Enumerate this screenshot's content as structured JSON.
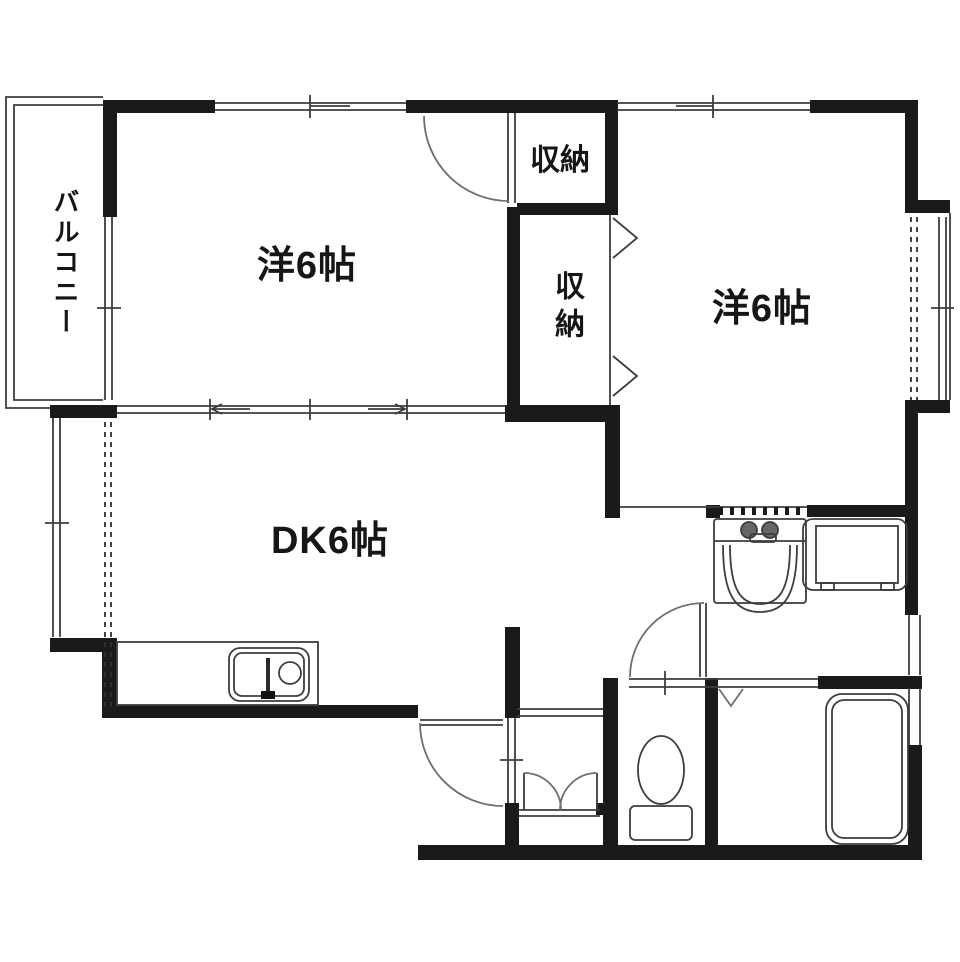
{
  "title": "apartment-floor-plan",
  "colors": {
    "wall": "#1a1a1a",
    "line": "#3d3d3d",
    "bg": "#ffffff"
  },
  "rooms": {
    "balcony": {
      "label": "バルコニー"
    },
    "western_room_left": {
      "label": "洋6帖"
    },
    "western_room_right": {
      "label": "洋6帖"
    },
    "dining_kitchen": {
      "label": "DK6帖"
    },
    "storage_top": {
      "label": "収納"
    },
    "storage_middle": {
      "label": "収納"
    }
  },
  "fixtures": [
    "kitchen-sink",
    "washbasin",
    "washing-machine-pan",
    "toilet",
    "bathtub"
  ]
}
